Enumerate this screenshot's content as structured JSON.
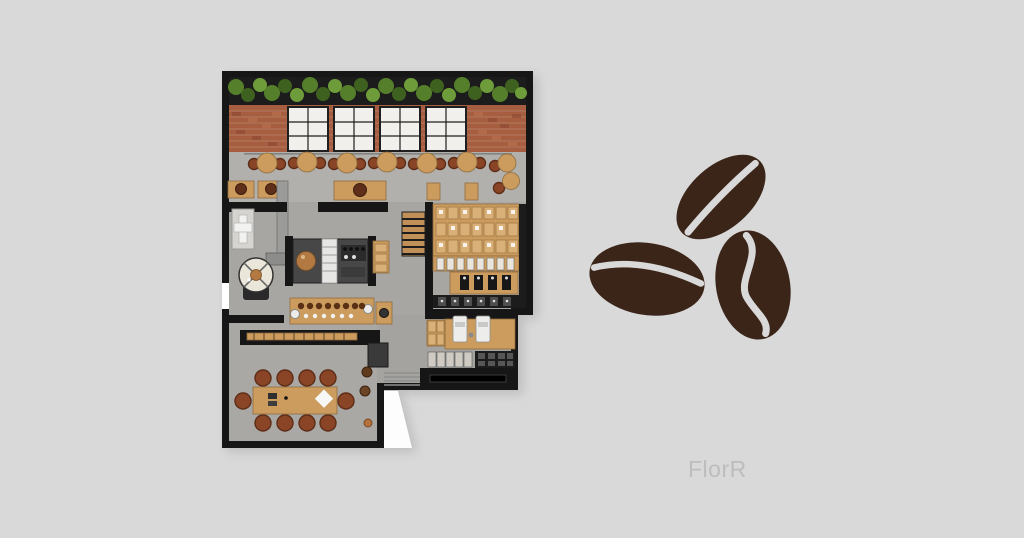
{
  "canvas": {
    "width": 1024,
    "height": 538,
    "background_color": "#d9d9d9"
  },
  "watermark": {
    "text": "FlorR",
    "color": "#bdbdbd"
  },
  "floorplan": {
    "name": "coffee-shop-floor-plan",
    "position": {
      "x": 222,
      "y": 71,
      "width": 311,
      "height": 377
    },
    "zones": [
      "hanging-plants-strip",
      "brick-wall-with-windows",
      "window-seating-row",
      "coffee-roaster-room",
      "espresso-bar-counter",
      "brew-bar",
      "staircase",
      "retail-coffee-bag-shelves",
      "pos-counter-with-registers",
      "communal-table-room",
      "entrance-walkway"
    ],
    "colors": {
      "wall": "#161616",
      "floor": "#a7a6a3",
      "floor_light": "#b1b0ad",
      "wood": "#cc9c5e",
      "wood_light": "#d9b078",
      "brick": "#a65d40",
      "brick_mortar": "#c59c86",
      "plant_dark": "#3f611f",
      "plant_mid": "#567f2b",
      "plant_light": "#6f9c3a",
      "chair_brown": "#8a4526",
      "chair_dark": "#5e2d17",
      "counter_gray": "#474747",
      "machine_white": "#ededeb",
      "copper": "#b27a42",
      "window_pane": "#f1f0ed",
      "cream": "#ebe6da"
    }
  },
  "beans_graphic": {
    "name": "coffee-beans-icon",
    "count": 3,
    "bean_color": "#3b2519",
    "crease_color": "#d9d9d9"
  }
}
